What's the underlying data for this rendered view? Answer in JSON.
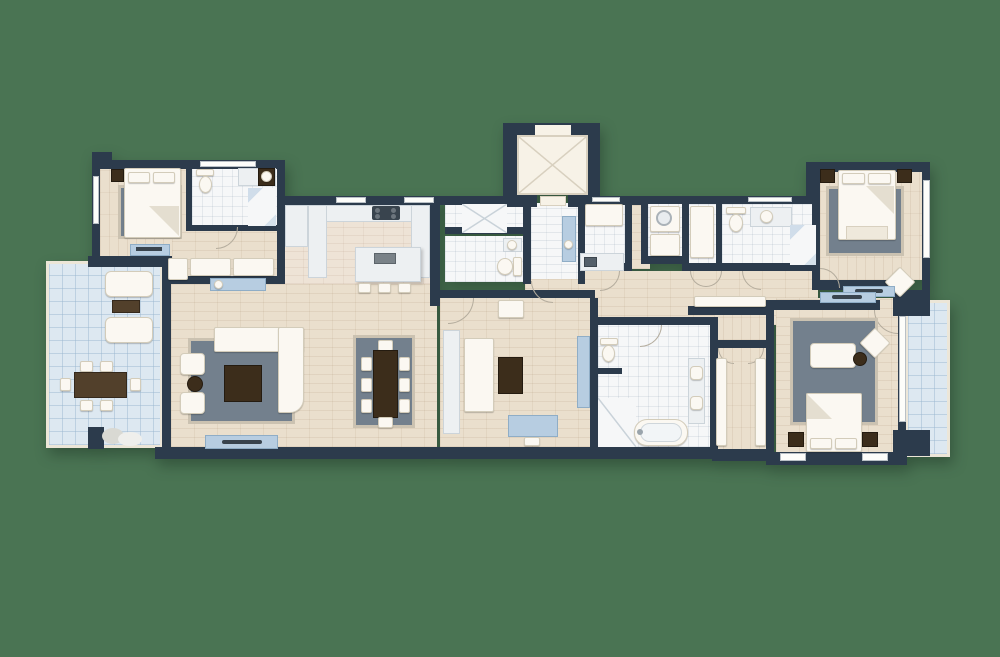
{
  "scene": {
    "type": "apartment-floor-plan",
    "description": "Top-down architectural floor plan of a wide apartment with two terraces, rendered on a plain green background. No text labels are visible.",
    "background": "#4a7453"
  },
  "palette": {
    "bg": "#4a7453",
    "wall": "#2c3b4c",
    "wood": "#eadfcd",
    "woodPink": "#eee3d6",
    "tile": "#f6f7f8",
    "terrace": "#dde8f1",
    "frame": "#ece6d8",
    "rug": "#73808d",
    "rugEdge": "#cbc2b1",
    "furnWhite": "#fbf8f2",
    "furnWhiteEdge": "#d3ccba",
    "furnBlue": "#b7cde1",
    "furnBlueEdge": "#8fadc6",
    "brown": "#52402b",
    "brownDark": "#3c2d1b",
    "marble": "#edf0f2",
    "marbleEdge": "#ccd4da",
    "elevator": "#f7f2e7",
    "elevatorLine": "#d8d0bf",
    "window": "#fdfdfa",
    "tvDark": "#39444e",
    "stone": "#d9d9d3"
  },
  "legend": {
    "rooms": [
      "bedroom-1",
      "ensuite-bathroom",
      "dressing-nook",
      "terrace-left",
      "living-room",
      "dining-area",
      "kitchen",
      "shower-room",
      "wc",
      "entry-foyer",
      "elevator",
      "laundry-room",
      "utility-closet",
      "hall-closet",
      "guest-bathroom",
      "guest-shower",
      "bedroom-2",
      "hallway",
      "master-bathroom",
      "walk-in-closet",
      "master-bedroom",
      "bedroom-3",
      "terrace-right"
    ],
    "furniture": [
      "double-bed",
      "nightstand",
      "area-rug",
      "wardrobe",
      "dresser-tv",
      "chaise-lounge",
      "outdoor-coffee-table",
      "outdoor-dining-table",
      "outdoor-chair",
      "sectional-sofa",
      "armchair",
      "coffee-table",
      "side-table",
      "tv-console",
      "tv",
      "dining-table",
      "dining-chair",
      "kitchen-counter",
      "cooktop",
      "kitchen-island",
      "bar-stool",
      "toilet",
      "sink-vanity",
      "shower",
      "bathtub",
      "washing-machine",
      "bench-runner",
      "desk",
      "desk-chair",
      "daybed",
      "console-table",
      "decorative-stones"
    ]
  }
}
